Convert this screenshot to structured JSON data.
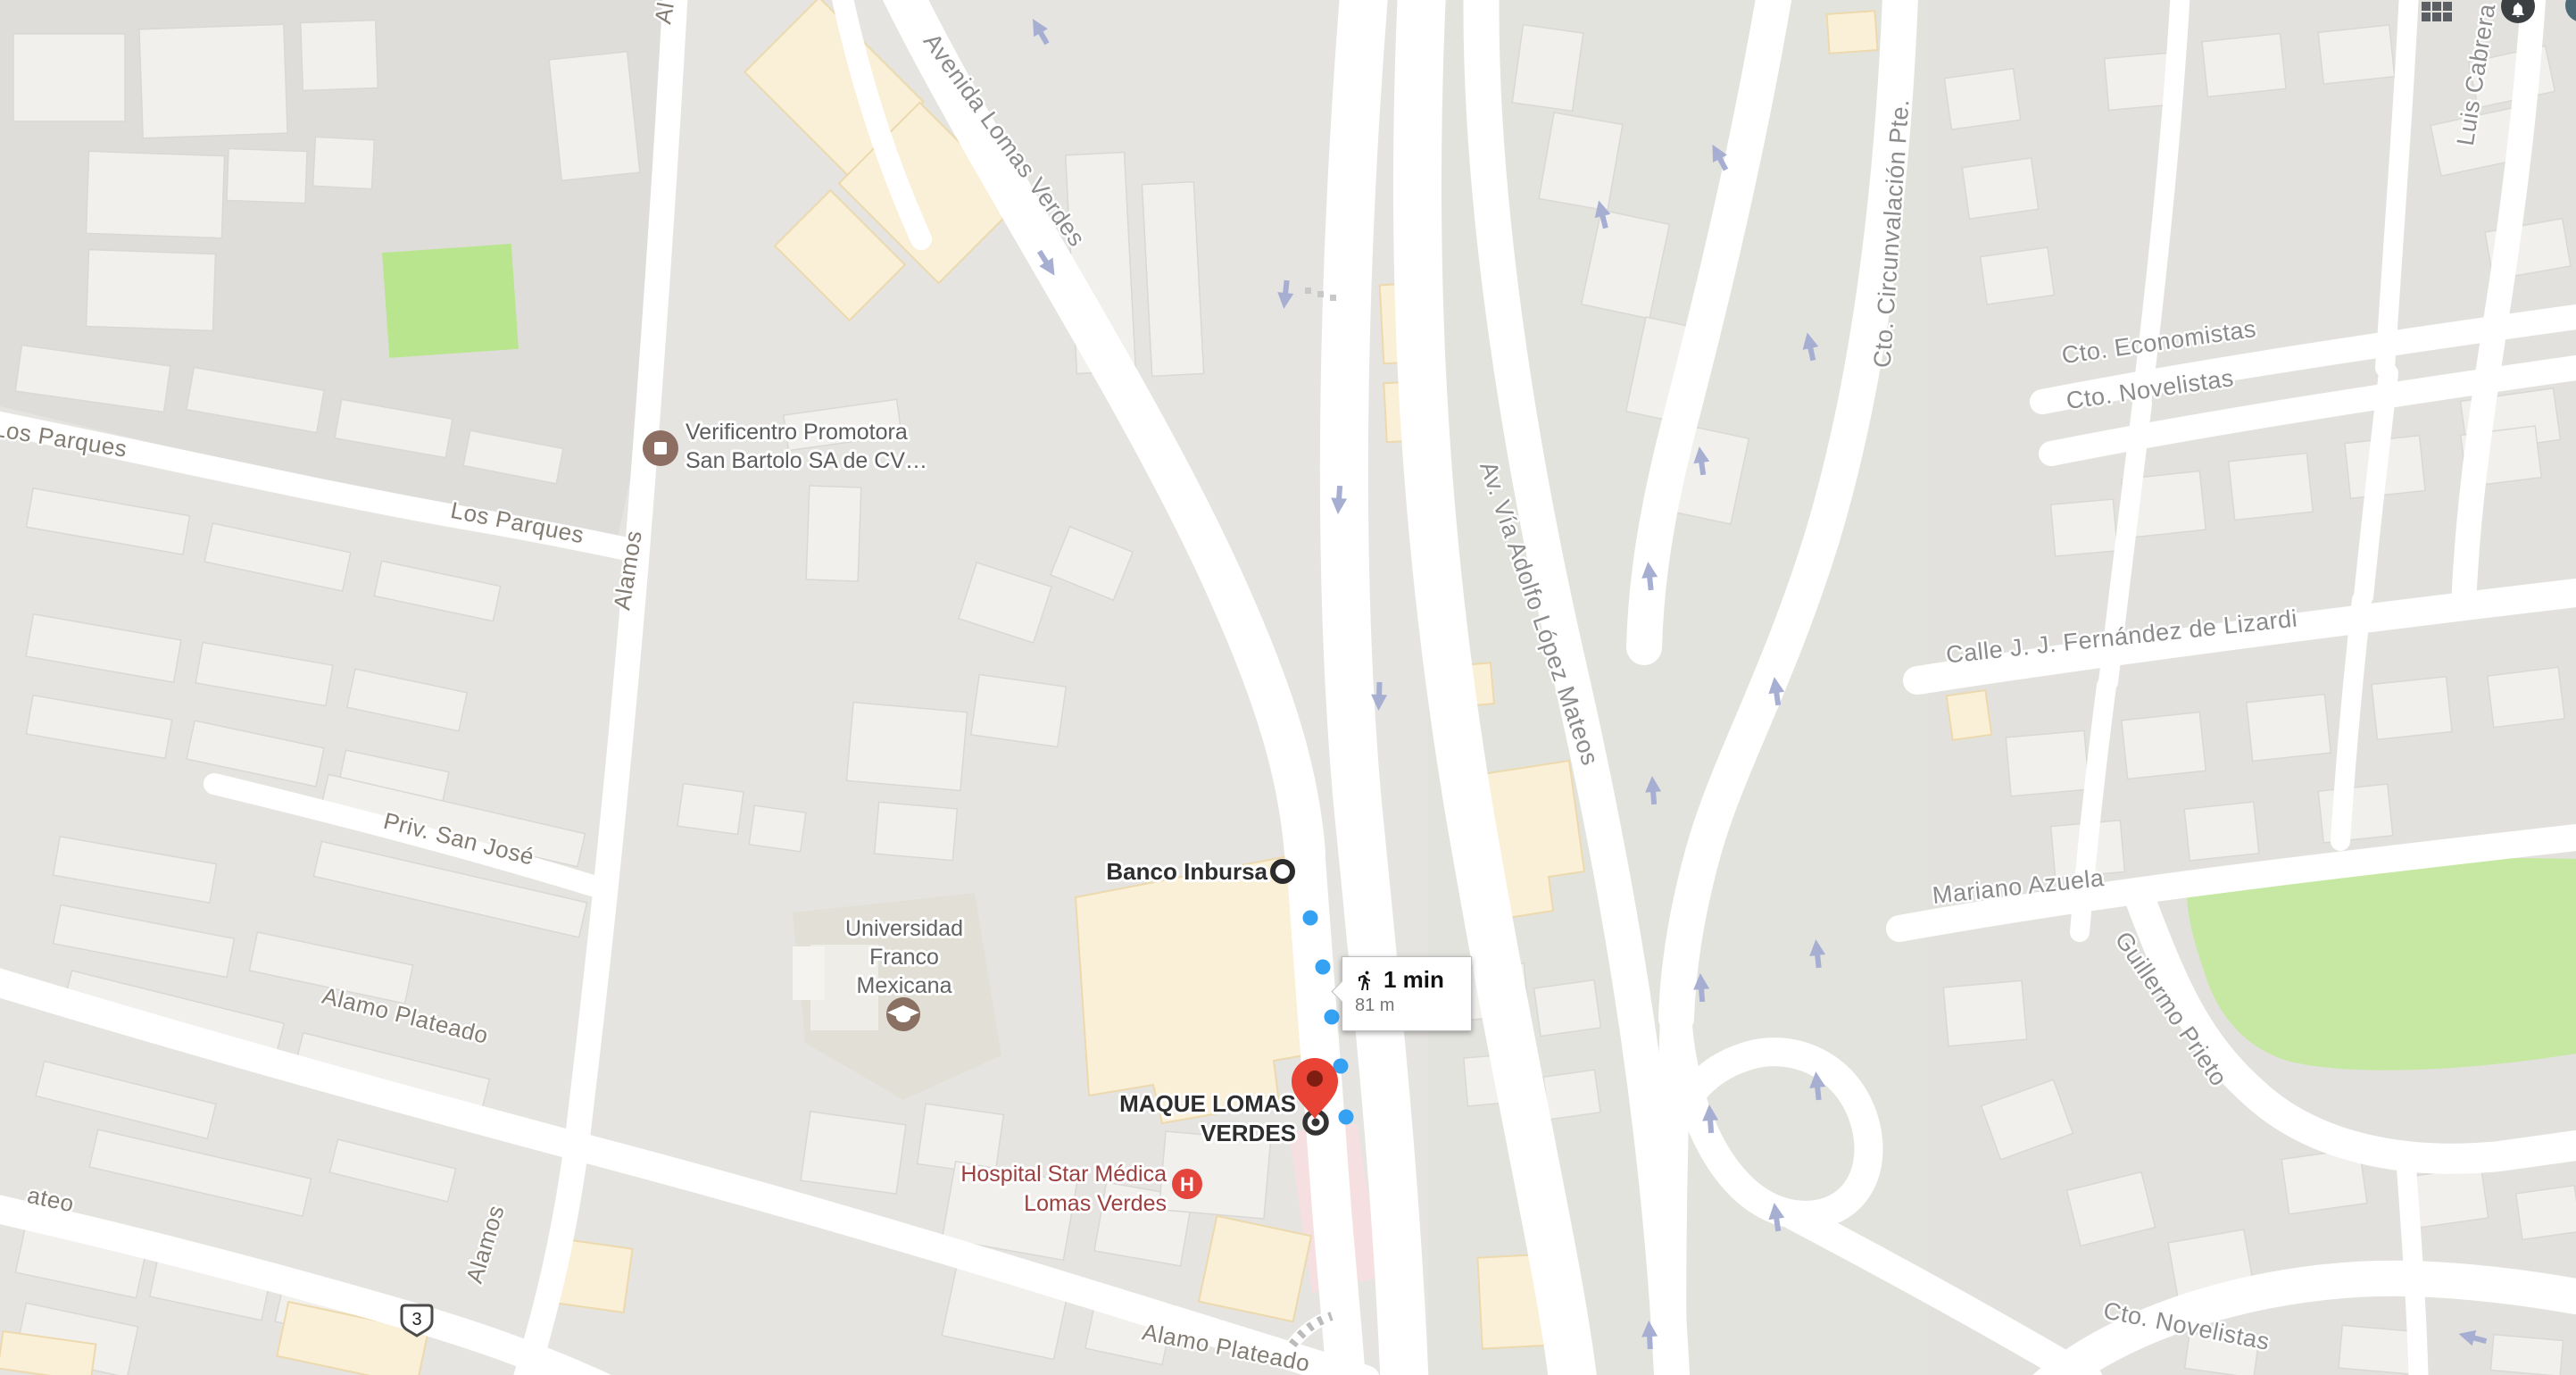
{
  "topbar": {
    "apps_icon": "apps-grid-icon",
    "notifications_icon": "bell-icon",
    "account_icon": "avatar-circle"
  },
  "route_tooltip": {
    "mode_icon": "walking-person-icon",
    "duration": "1 min",
    "distance": "81 m"
  },
  "markers": {
    "origin_circle": "route-origin-circle",
    "destination_pin": "red-map-pin",
    "destination_target": "target-circle",
    "dot_color": "#34a1f3",
    "pin_color": "#e94335"
  },
  "pois": {
    "verificentro_line1": "Verificentro Promotora",
    "verificentro_line2": "San Bartolo SA de CV…",
    "verificentro_icon": "shop-square-icon",
    "banco_inbursa": "Banco Inbursa",
    "maque_line1": "MAQUE LOMAS",
    "maque_line2": "VERDES",
    "hospital_line1": "Hospital Star Médica",
    "hospital_line2": "Lomas Verdes",
    "hospital_icon_letter": "H",
    "universidad_line1": "Universidad",
    "universidad_line2": "Franco",
    "universidad_line3": "Mexicana",
    "universidad_icon": "graduation-cap-icon"
  },
  "streets": {
    "avenida_lomas_verdes": "Avenida Lomas Verdes",
    "lopez_mateos": "Av. Vía Adolfo López Mateos",
    "circunvalacion": "Cto. Circunvalación Pte.",
    "economistas": "Cto. Economistas",
    "novelistas_top": "Cto. Novelistas",
    "fernandez_lizardi": "Calle J. J. Fernández de Lizardi",
    "mariano_azuela": "Mariano Azuela",
    "guillermo_prieto": "Guillermo Prieto",
    "luis_cabrera": "Luis Cabrera",
    "los_parques_a": "Los Parques",
    "los_parques_b": "Los Parques",
    "alamos_upper": "Alamos",
    "alamos_lower": "Alamos",
    "priv_san_jose": "Priv. San José",
    "alamo_plateado_left": "Alamo Plateado",
    "alamo_plateado_bottom": "Alamo Plateado",
    "novelistas_bottom": "Cto. Novelistas",
    "partial_ateo": "ateo",
    "partial_al": "Al"
  },
  "road_shield": {
    "number": "3"
  },
  "map_colors": {
    "background": "#e5e4e0",
    "road": "#ffffff",
    "park": "#c6e8a2",
    "building": "#f1f0ed",
    "commercial_building": "#faf0d8",
    "hospital_area": "#f6dfe0",
    "one_way_arrow": "#a6aed2"
  }
}
